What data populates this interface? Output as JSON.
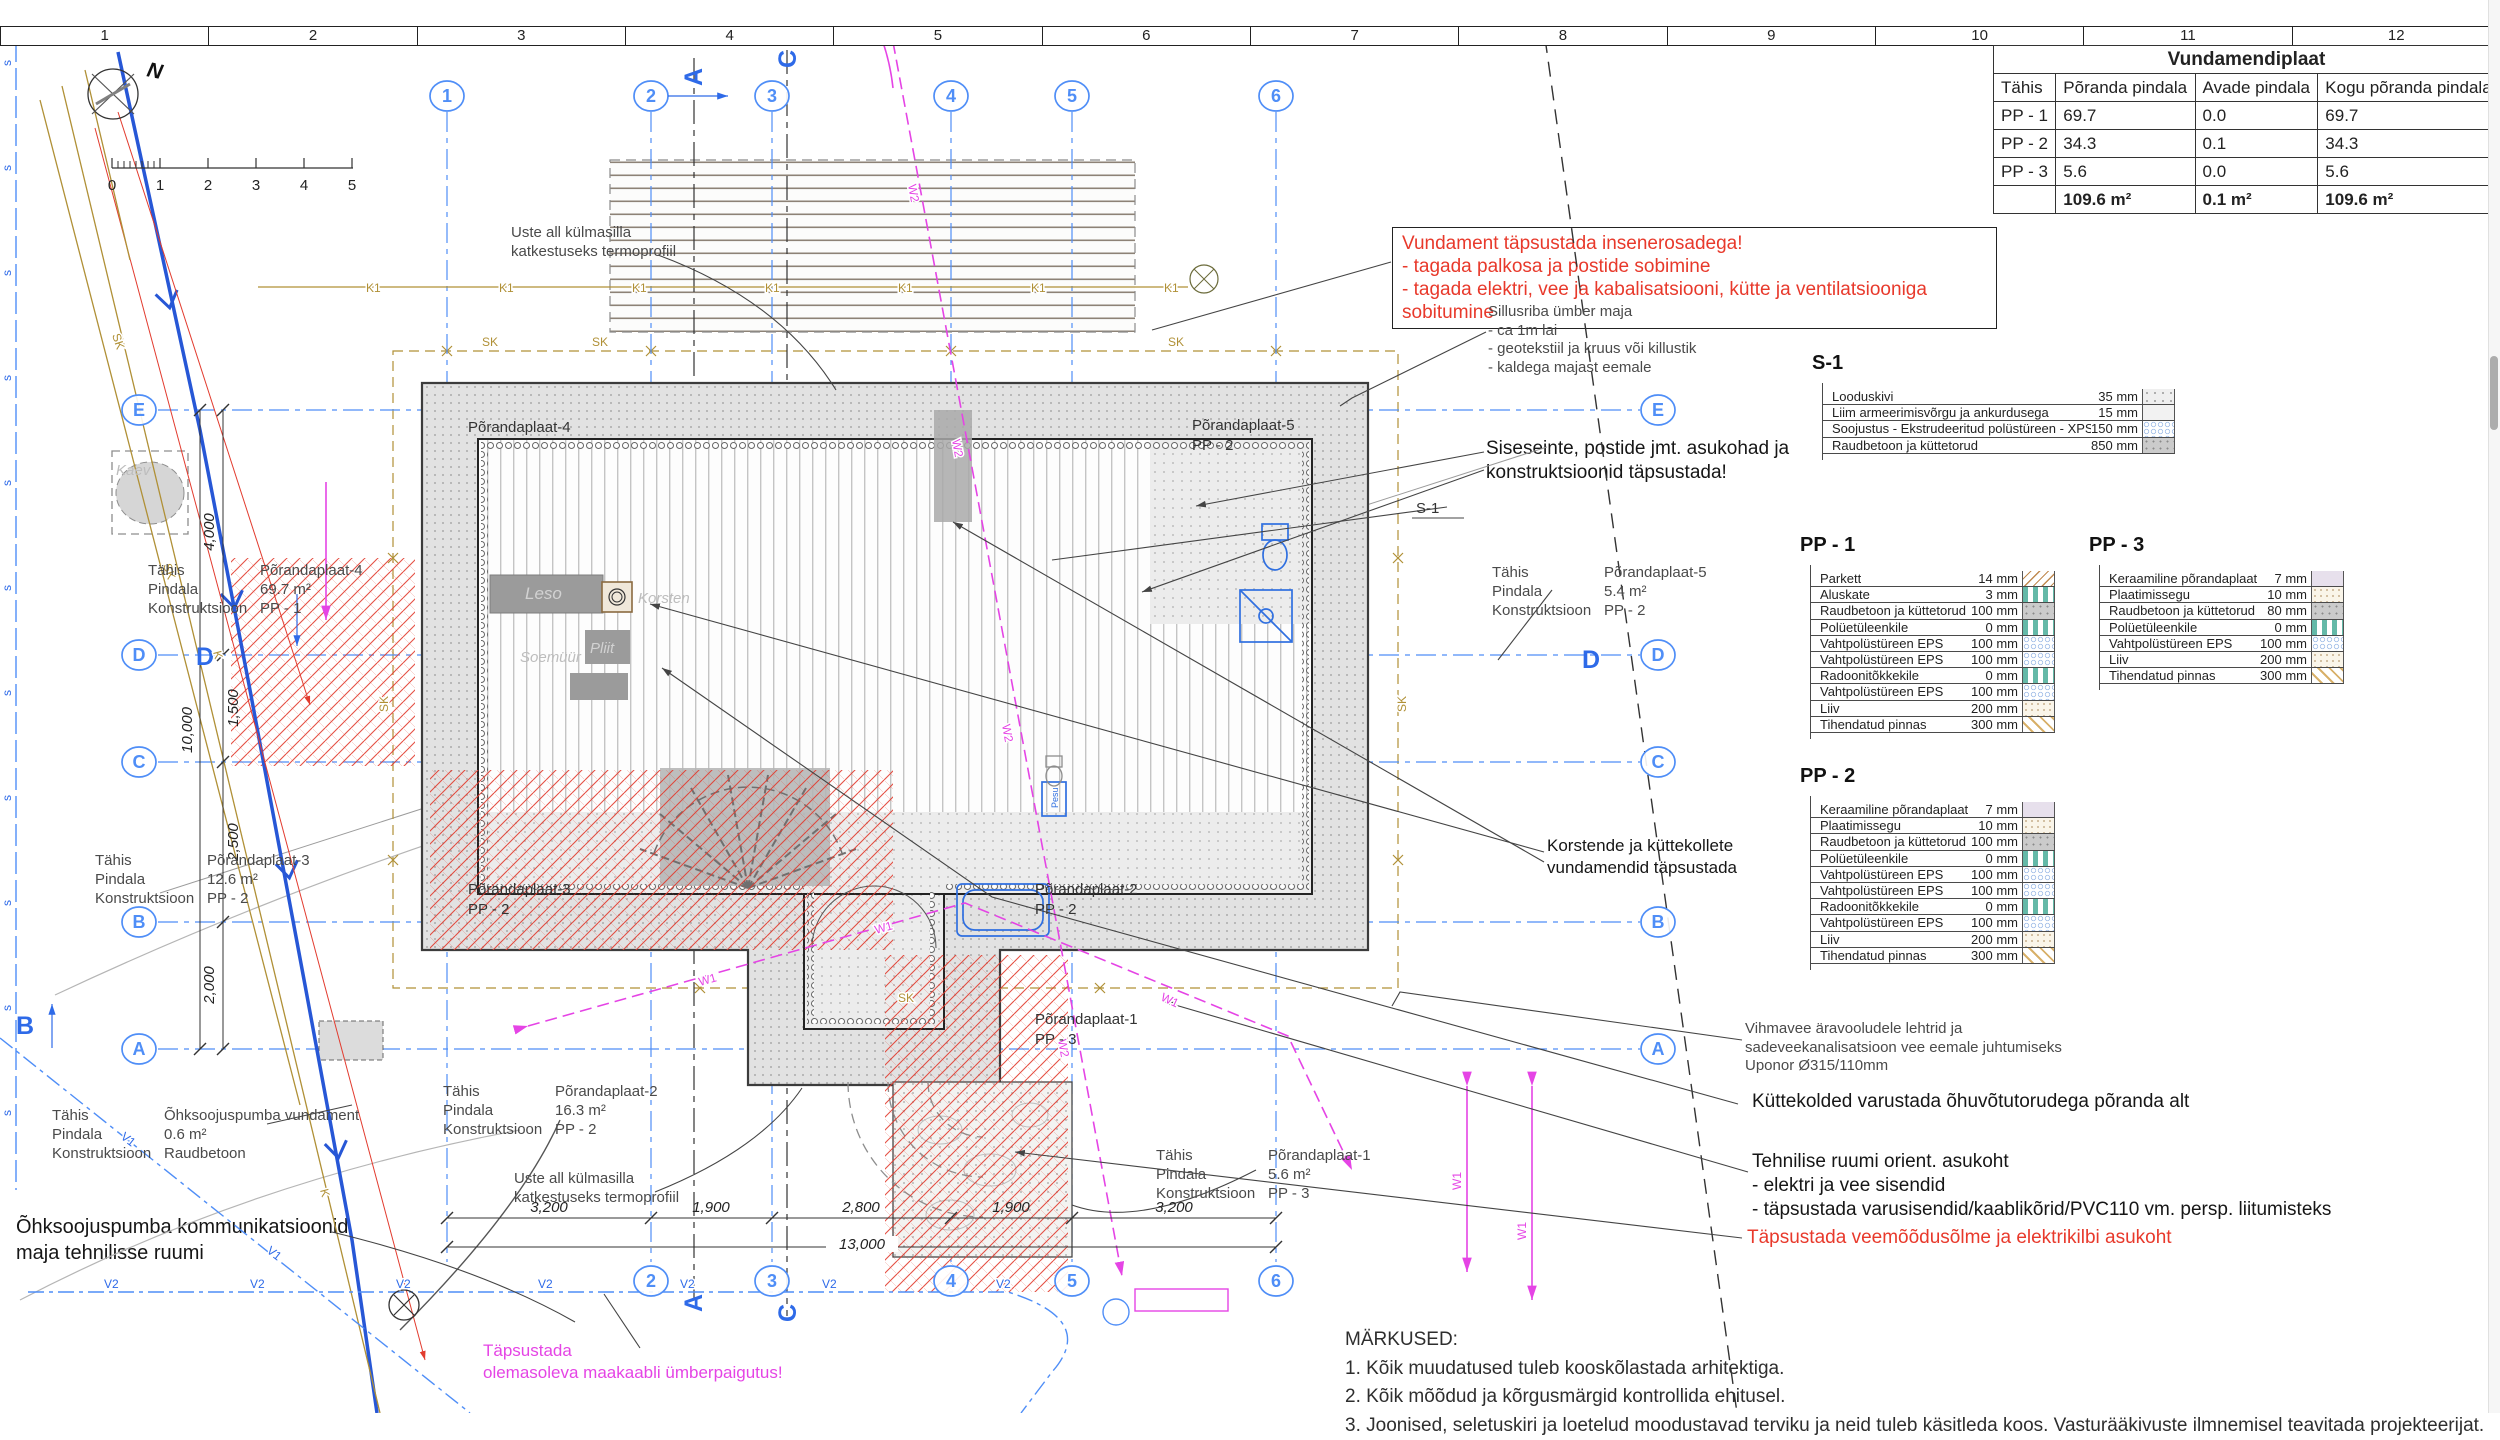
{
  "ruler": {
    "cells": [
      "1",
      "2",
      "3",
      "4",
      "5",
      "6",
      "7",
      "8",
      "9",
      "10",
      "11",
      "12"
    ]
  },
  "scale_bar": {
    "ticks": [
      "0",
      "1",
      "2",
      "3",
      "4",
      "5"
    ]
  },
  "compass": {
    "label": "N"
  },
  "summary_table": {
    "title": "Vundamendiplaat",
    "columns": [
      "Tähis",
      "Põranda pindala",
      "Avade pindala",
      "Kogu põranda pindala"
    ],
    "rows": [
      {
        "t": "PP - 1",
        "p": "69.7",
        "a": "0.0",
        "k": "69.7"
      },
      {
        "t": "PP - 2",
        "p": "34.3",
        "a": "0.1",
        "k": "34.3"
      },
      {
        "t": "PP - 3",
        "p": "5.6",
        "a": "0.0",
        "k": "5.6"
      }
    ],
    "totals": {
      "t": "",
      "p": "109.6 m²",
      "a": "0.1 m²",
      "k": "109.6 m²"
    }
  },
  "panels": {
    "s1": {
      "title": "S-1",
      "rows": [
        {
          "name": "Looduskivi",
          "value": "35 mm",
          "swatch": "stone"
        },
        {
          "name": "Liim armeerimisvõrgu ja ankurdusega",
          "value": "15 mm",
          "swatch": "glue"
        },
        {
          "name": "Soojustus - Ekstrudeeritud polüstüreen - XPS",
          "value": "150 mm",
          "swatch": "eps"
        },
        {
          "name": "Raudbetoon ja küttetorud",
          "value": "850 mm",
          "swatch": "concrete"
        }
      ]
    },
    "pp1": {
      "title": "PP - 1",
      "rows": [
        {
          "name": "Parkett",
          "value": "14 mm",
          "swatch": "parquet"
        },
        {
          "name": "Aluskate",
          "value": "3 mm",
          "swatch": "membrane"
        },
        {
          "name": "Raudbetoon ja küttetorud",
          "value": "100 mm",
          "swatch": "concrete"
        },
        {
          "name": "Polüetüleenkile",
          "value": "0 mm",
          "swatch": "membrane"
        },
        {
          "name": "Vahtpolüstüreen EPS",
          "value": "100 mm",
          "swatch": "eps"
        },
        {
          "name": "Vahtpolüstüreen EPS",
          "value": "100 mm",
          "swatch": "eps"
        },
        {
          "name": "Radoonitõkkekile",
          "value": "0 mm",
          "swatch": "membrane"
        },
        {
          "name": "Vahtpolüstüreen EPS",
          "value": "100 mm",
          "swatch": "eps"
        },
        {
          "name": "Liiv",
          "value": "200 mm",
          "swatch": "sand"
        },
        {
          "name": "Tihendatud pinnas",
          "value": "300 mm",
          "swatch": "ground"
        }
      ]
    },
    "pp2": {
      "title": "PP - 2",
      "rows": [
        {
          "name": "Keraamiline põrandaplaat",
          "value": "7 mm",
          "swatch": "tile"
        },
        {
          "name": "Plaatimissegu",
          "value": "10 mm",
          "swatch": "sand"
        },
        {
          "name": "Raudbetoon ja küttetorud",
          "value": "100 mm",
          "swatch": "concrete"
        },
        {
          "name": "Polüetüleenkile",
          "value": "0 mm",
          "swatch": "membrane"
        },
        {
          "name": "Vahtpolüstüreen EPS",
          "value": "100 mm",
          "swatch": "eps"
        },
        {
          "name": "Vahtpolüstüreen EPS",
          "value": "100 mm",
          "swatch": "eps"
        },
        {
          "name": "Radoonitõkkekile",
          "value": "0 mm",
          "swatch": "membrane"
        },
        {
          "name": "Vahtpolüstüreen EPS",
          "value": "100 mm",
          "swatch": "eps"
        },
        {
          "name": "Liiv",
          "value": "200 mm",
          "swatch": "sand"
        },
        {
          "name": "Tihendatud pinnas",
          "value": "300 mm",
          "swatch": "ground"
        }
      ]
    },
    "pp3": {
      "title": "PP - 3",
      "rows": [
        {
          "name": "Keraamiline põrandaplaat",
          "value": "7 mm",
          "swatch": "tile"
        },
        {
          "name": "Plaatimissegu",
          "value": "10 mm",
          "swatch": "sand"
        },
        {
          "name": "Raudbetoon ja küttetorud",
          "value": "80 mm",
          "swatch": "concrete"
        },
        {
          "name": "Polüetüleenkile",
          "value": "0 mm",
          "swatch": "membrane"
        },
        {
          "name": "Vahtpolüstüreen EPS",
          "value": "100 mm",
          "swatch": "eps"
        },
        {
          "name": "Liiv",
          "value": "200 mm",
          "swatch": "sand"
        },
        {
          "name": "Tihendatud pinnas",
          "value": "300 mm",
          "swatch": "ground"
        }
      ]
    }
  },
  "slab_info": {
    "pp4": {
      "rows": [
        {
          "label": "Tähis",
          "value": "Põrandaplaat-4"
        },
        {
          "label": "Pindala",
          "value": "69.7 m²"
        },
        {
          "label": "Konstruktsioon",
          "value": "PP - 1"
        }
      ]
    },
    "pp3i": {
      "rows": [
        {
          "label": "Tähis",
          "value": "Põrandaplaat-3"
        },
        {
          "label": "Pindala",
          "value": "12.6 m²"
        },
        {
          "label": "Konstruktsioon",
          "value": "PP - 2"
        }
      ]
    },
    "pump": {
      "rows": [
        {
          "label": "Tähis",
          "value": "Õhksoojuspumba vundament"
        },
        {
          "label": "Pindala",
          "value": "0.6 m²"
        },
        {
          "label": "Konstruktsioon",
          "value": "Raudbetoon"
        }
      ]
    },
    "pp2i": {
      "rows": [
        {
          "label": "Tähis",
          "value": "Põrandaplaat-2"
        },
        {
          "label": "Pindala",
          "value": "16.3 m²"
        },
        {
          "label": "Konstruktsioon",
          "value": "PP - 2"
        }
      ]
    },
    "pp5i": {
      "rows": [
        {
          "label": "Tähis",
          "value": "Põrandaplaat-5"
        },
        {
          "label": "Pindala",
          "value": "5.4 m²"
        },
        {
          "label": "Konstruktsioon",
          "value": "PP - 2"
        }
      ]
    },
    "pp1i": {
      "rows": [
        {
          "label": "Tähis",
          "value": "Põrandaplaat-1"
        },
        {
          "label": "Pindala",
          "value": "5.6 m²"
        },
        {
          "label": "Konstruktsioon",
          "value": "PP - 3"
        }
      ]
    }
  },
  "annotations": {
    "red_box": "Vundament täpsustada insenerosadega!\n- tagada palkosa ja postide sobimine\n- tagada elektri, vee ja kabalisatsiooni, kütte ja ventilatsiooniga sobitumine",
    "sillusriba": "Sillusriba ümber maja\n- ca 1m lai\n- geotekstiil ja kruus või killustik\n- kaldega majast eemale",
    "siseseinte": "Siseseinte, postide jmt. asukohad ja\nkonstruktsioonid täpsustada!",
    "korstende": "Korstende ja küttekollete\nvundamendid täpsustada",
    "vihmavee": "Vihmavee äravooludele lehtrid ja\nsadeveekanalisatsioon vee eemale juhtumiseks\nUponor Ø315/110mm",
    "kuttekolded": "Küttekolded varustada õhuvõtutorudega põranda alt",
    "tehnilise": "Tehnilise ruumi orient. asukoht\n- elektri ja vee sisendid\n- täpsustada varusisendid/kaablikõrid/PVC110 vm. persp. liitumisteks",
    "red_bottom": "Täpsustada veemõõdusõlme ja elektrikilbi asukoht",
    "ohksoojus": "Õhksoojuspumba kommunikatsioonid\nmaja tehnilisse ruumi",
    "uste": "Uste all külmasilla\nkatkestuseks termoprofiil",
    "maakaabel": "Täpsustada\nolemasoleva maakaabli ümberpaigutus!"
  },
  "notes": {
    "title": "MÄRKUSED:",
    "items": [
      "1. Kõik muudatused tuleb kooskõlastada arhitektiga.",
      "2. Kõik mõõdud ja kõrgusmärgid kontrollida ehitusel.",
      "3. Joonised, seletuskiri ja loetelud moodustavad terviku ja neid tuleb käsitleda koos. Vasturääkivuste ilmnemisel teavitada projekteerijat."
    ]
  },
  "plan": {
    "slabs": {
      "p4": "Põrandaplaat-4",
      "p5a": "Põrandaplaat-5",
      "p5b": "PP - 2",
      "p3a": "Põrandaplaat-3",
      "p3b": "PP - 2",
      "p2a": "Põrandaplaat-2",
      "p2b": "PP - 2",
      "p1a": "Põrandaplaat-1",
      "p1b": "PP - 3"
    },
    "rooms": {
      "leso": "Leso",
      "soemuur": "Soemüür",
      "pliit": "Pliit",
      "korsten": "Korsten",
      "pesu": "Pesu",
      "kaev": "Kaev"
    },
    "s1_ref": "S-1",
    "grid": {
      "cols": [
        "1",
        "2",
        "3",
        "4",
        "5",
        "6"
      ],
      "rows": [
        "E",
        "D",
        "C",
        "B",
        "A"
      ],
      "sec_a": "A",
      "sec_c": "C",
      "sec_d": "D",
      "sec_b": "B"
    },
    "dims": {
      "bottom": [
        "3,200",
        "1,900",
        "2,800",
        "1,900",
        "3,200"
      ],
      "bottom_total": "13,000",
      "left": [
        "4,000",
        "1,500",
        "2,500",
        "2,000"
      ],
      "left_total": "10,000"
    },
    "lines": {
      "w1": "W1",
      "w2": "W2",
      "v1": "V1",
      "v2": "V2",
      "k": "K",
      "k1": "K1",
      "sk": "SK",
      "s": "s"
    }
  },
  "colors": {
    "axis_blue": "#4f8ef7",
    "magenta": "#e544e5",
    "red": "#e8392b",
    "tan": "#b09036",
    "cable_blue": "#2757d6"
  }
}
